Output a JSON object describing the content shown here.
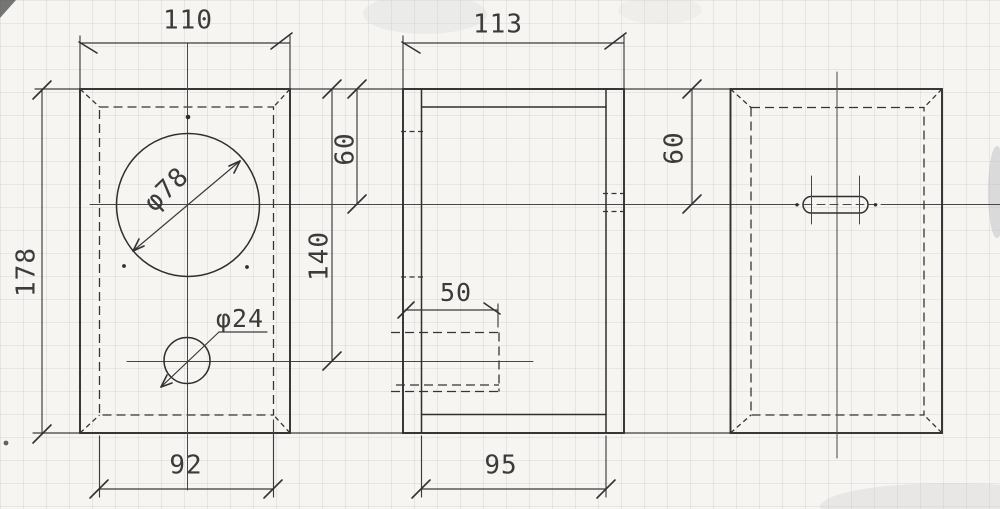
{
  "sheet": {
    "description": "Scanned three-view dimensioned technical drawing of a small speaker enclosure on graph paper",
    "paper_color": "#f6f5f1",
    "ink_color": "#2f2f2f",
    "grid_color": "#aab0ba"
  },
  "front_view": {
    "label": "front view",
    "width": "110",
    "height": "178",
    "inner_width": "92",
    "driver_hole": "φ78",
    "duct_hole": "φ24"
  },
  "side_view": {
    "label": "side view",
    "depth": "113",
    "driver_axis_from_top": "60",
    "duct_axis_from_top": "140",
    "duct_length": "50",
    "inner_depth": "95"
  },
  "back_view": {
    "label": "back view",
    "terminal_axis_from_top": "60"
  }
}
